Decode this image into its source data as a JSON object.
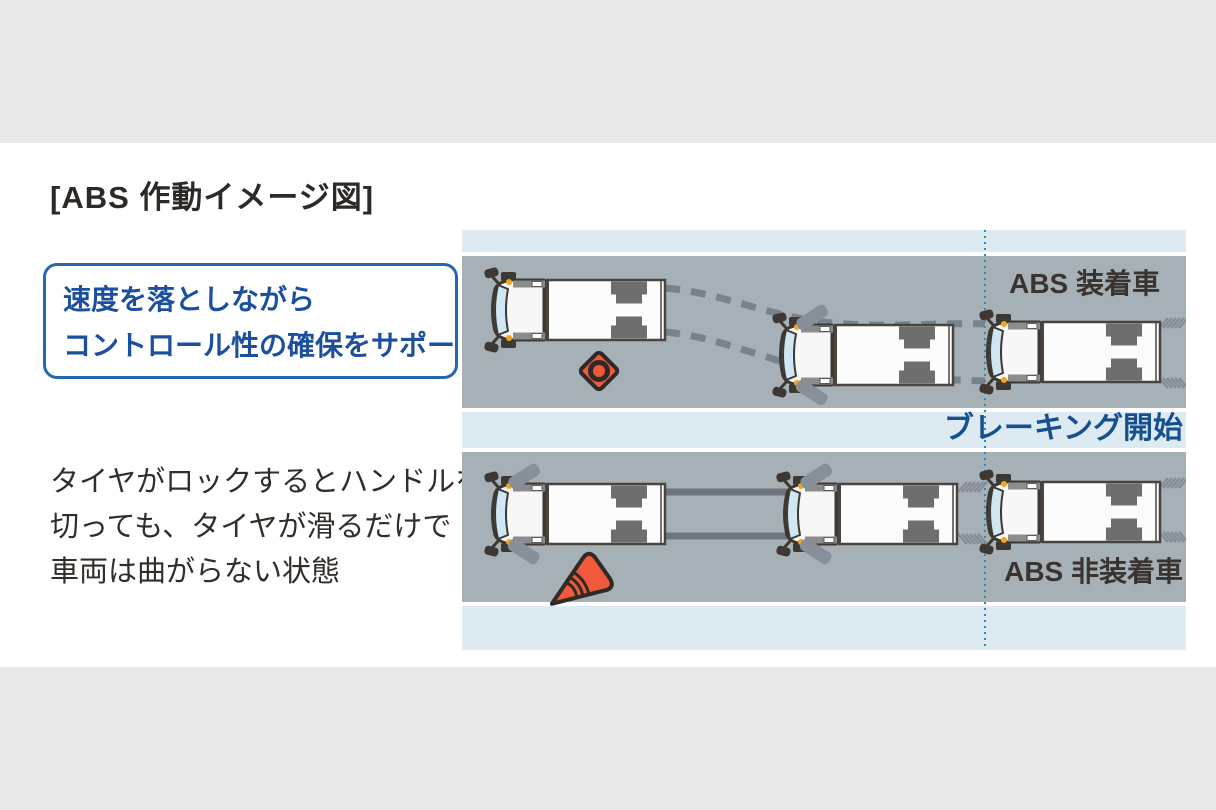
{
  "title": "[ABS 作動イメージ図]",
  "callout": {
    "line1": "速度を落としながら",
    "line2": "コントロール性の確保をサポート"
  },
  "description": {
    "line1": "タイヤがロックするとハンドルを",
    "line2": "切っても、タイヤが滑るだけで",
    "line3": "車両は曲がらない状態"
  },
  "diagram": {
    "abs_equipped_label": "ABS 装着車",
    "braking_start_label": "ブレーキング開始",
    "abs_not_equipped_label": "ABS 非装着車"
  },
  "icons": {
    "top_road_obstacle": "traffic-cone-top-view-icon",
    "bottom_road_obstacle": "fallen-traffic-cone-icon"
  },
  "colors": {
    "page_background": "#ffffff",
    "outer_band": "#e9e9e9",
    "road": "#a6b0b7",
    "light_blue_strip": "#ddeaf2",
    "callout_border": "#2767ae",
    "callout_text": "#1d4f9f",
    "braking_text": "#15508f",
    "body_text": "#332d2a",
    "label_text": "#3a3430",
    "cone_fill": "#f0593a",
    "cone_outline": "#2f2a28",
    "skid_mark": "#78828b",
    "braking_line": "#2e8bb9"
  }
}
